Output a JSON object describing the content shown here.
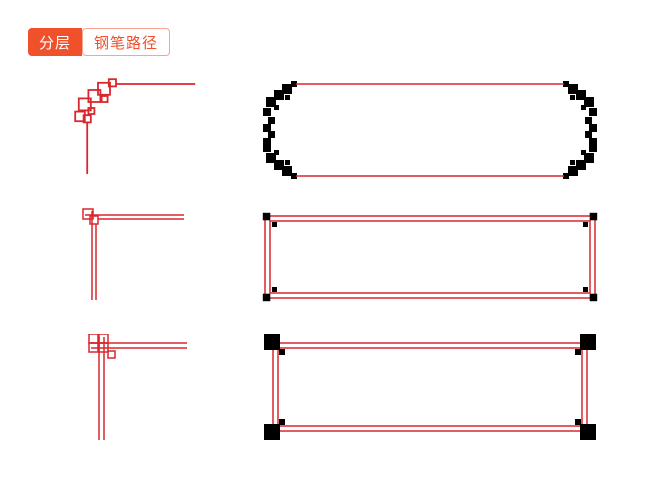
{
  "header": {
    "tabs": [
      {
        "label": "分层",
        "active": true
      },
      {
        "label": "钢笔路径",
        "active": false
      }
    ]
  },
  "colors": {
    "tab_active_bg": "#f0502a",
    "tab_active_text": "#ffffff",
    "tab_inactive_text": "#f0502a",
    "tab_inactive_border": "#f7a491",
    "frame_red": "#d9272e",
    "background": "#ffffff"
  },
  "gallery": {
    "items": [
      {
        "name": "fret-corner-detail"
      },
      {
        "name": "fret-border-frame"
      },
      {
        "name": "interlock-corner-detail"
      },
      {
        "name": "interlock-border-frame"
      },
      {
        "name": "knot-corner-detail"
      },
      {
        "name": "knot-border-frame"
      }
    ]
  }
}
